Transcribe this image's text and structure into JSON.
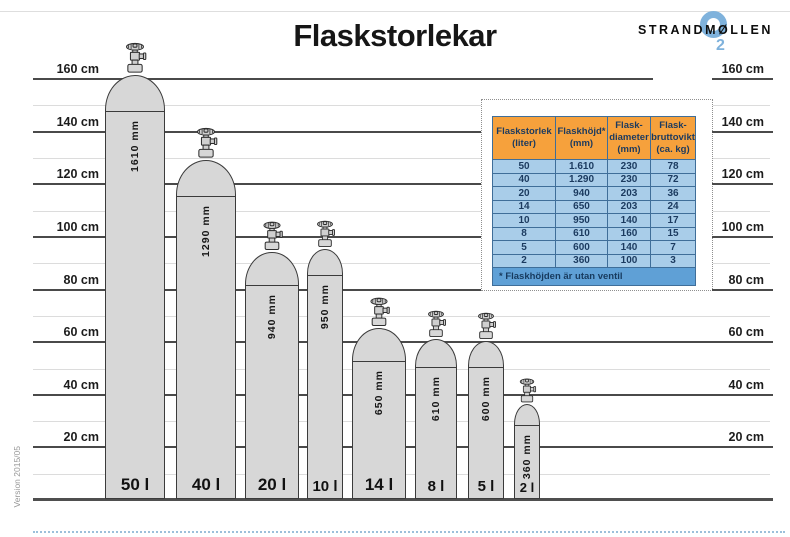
{
  "title": "Flaskstorlekar",
  "logo": {
    "brand": "STRANDMØLLEN",
    "o2_sub": "2",
    "blue": "#7FB2DC"
  },
  "version": "Version 2015/05",
  "axis": {
    "unit": "cm",
    "major_values": [
      160,
      140,
      120,
      100,
      80,
      60,
      40,
      20
    ],
    "labels": [
      "160 cm",
      "140 cm",
      "120 cm",
      "100 cm",
      "80 cm",
      "60 cm",
      "40 cm",
      "20 cm"
    ]
  },
  "cylinders": [
    {
      "volume_label": "50 l",
      "height_label": "1610 mm",
      "height_mm": 1610,
      "diameter_mm": 230
    },
    {
      "volume_label": "40 l",
      "height_label": "1290 mm",
      "height_mm": 1290,
      "diameter_mm": 230
    },
    {
      "volume_label": "20 l",
      "height_label": "940 mm",
      "height_mm": 940,
      "diameter_mm": 203
    },
    {
      "volume_label": "10 l",
      "height_label": "950 mm",
      "height_mm": 950,
      "diameter_mm": 140
    },
    {
      "volume_label": "14 l",
      "height_label": "650 mm",
      "height_mm": 650,
      "diameter_mm": 203
    },
    {
      "volume_label": "8 l",
      "height_label": "610 mm",
      "height_mm": 610,
      "diameter_mm": 160
    },
    {
      "volume_label": "5 l",
      "height_label": "600 mm",
      "height_mm": 600,
      "diameter_mm": 140
    },
    {
      "volume_label": "2 l",
      "height_label": "360 mm",
      "height_mm": 360,
      "diameter_mm": 100
    }
  ],
  "table": {
    "headers": [
      "Flaskstorlek\n(liter)",
      "Flaskhöjd*\n(mm)",
      "Flask-\ndiameter\n(mm)",
      "Flask-\nbruttovikt\n(ca. kg)"
    ],
    "rows": [
      [
        "50",
        "1.610",
        "230",
        "78"
      ],
      [
        "40",
        "1.290",
        "230",
        "72"
      ],
      [
        "20",
        "940",
        "203",
        "36"
      ],
      [
        "14",
        "650",
        "203",
        "24"
      ],
      [
        "10",
        "950",
        "140",
        "17"
      ],
      [
        "8",
        "610",
        "160",
        "15"
      ],
      [
        "5",
        "600",
        "140",
        "7"
      ],
      [
        "2",
        "360",
        "100",
        "3"
      ]
    ],
    "footnote": "* Flaskhöjden är utan ventil",
    "header_bg": "#F6A13C",
    "row_bg": "#A9CDE9",
    "footer_bg": "#5FA0D6"
  },
  "chart_data": {
    "type": "bar",
    "title": "Flaskstorlekar",
    "categories": [
      "50 l",
      "40 l",
      "20 l",
      "10 l",
      "14 l",
      "8 l",
      "5 l",
      "2 l"
    ],
    "series": [
      {
        "name": "Flaskhöjd (mm)",
        "values": [
          1610,
          1290,
          940,
          950,
          650,
          610,
          600,
          360
        ]
      },
      {
        "name": "Flaskdiameter (mm)",
        "values": [
          230,
          230,
          203,
          140,
          203,
          160,
          140,
          100
        ]
      },
      {
        "name": "Flaskbruttovikt (ca. kg)",
        "values": [
          78,
          72,
          36,
          24,
          17,
          15,
          7,
          3
        ]
      }
    ],
    "ylabel": "cm",
    "ylim": [
      0,
      170
    ],
    "yticks": [
      20,
      40,
      60,
      80,
      100,
      120,
      140,
      160
    ],
    "grid": "major 20 cm dark, minor 10 cm light",
    "note": "Gas cylinders drawn to scale against the cm axis; bar order differs from table order (10 l before 14 l)."
  }
}
